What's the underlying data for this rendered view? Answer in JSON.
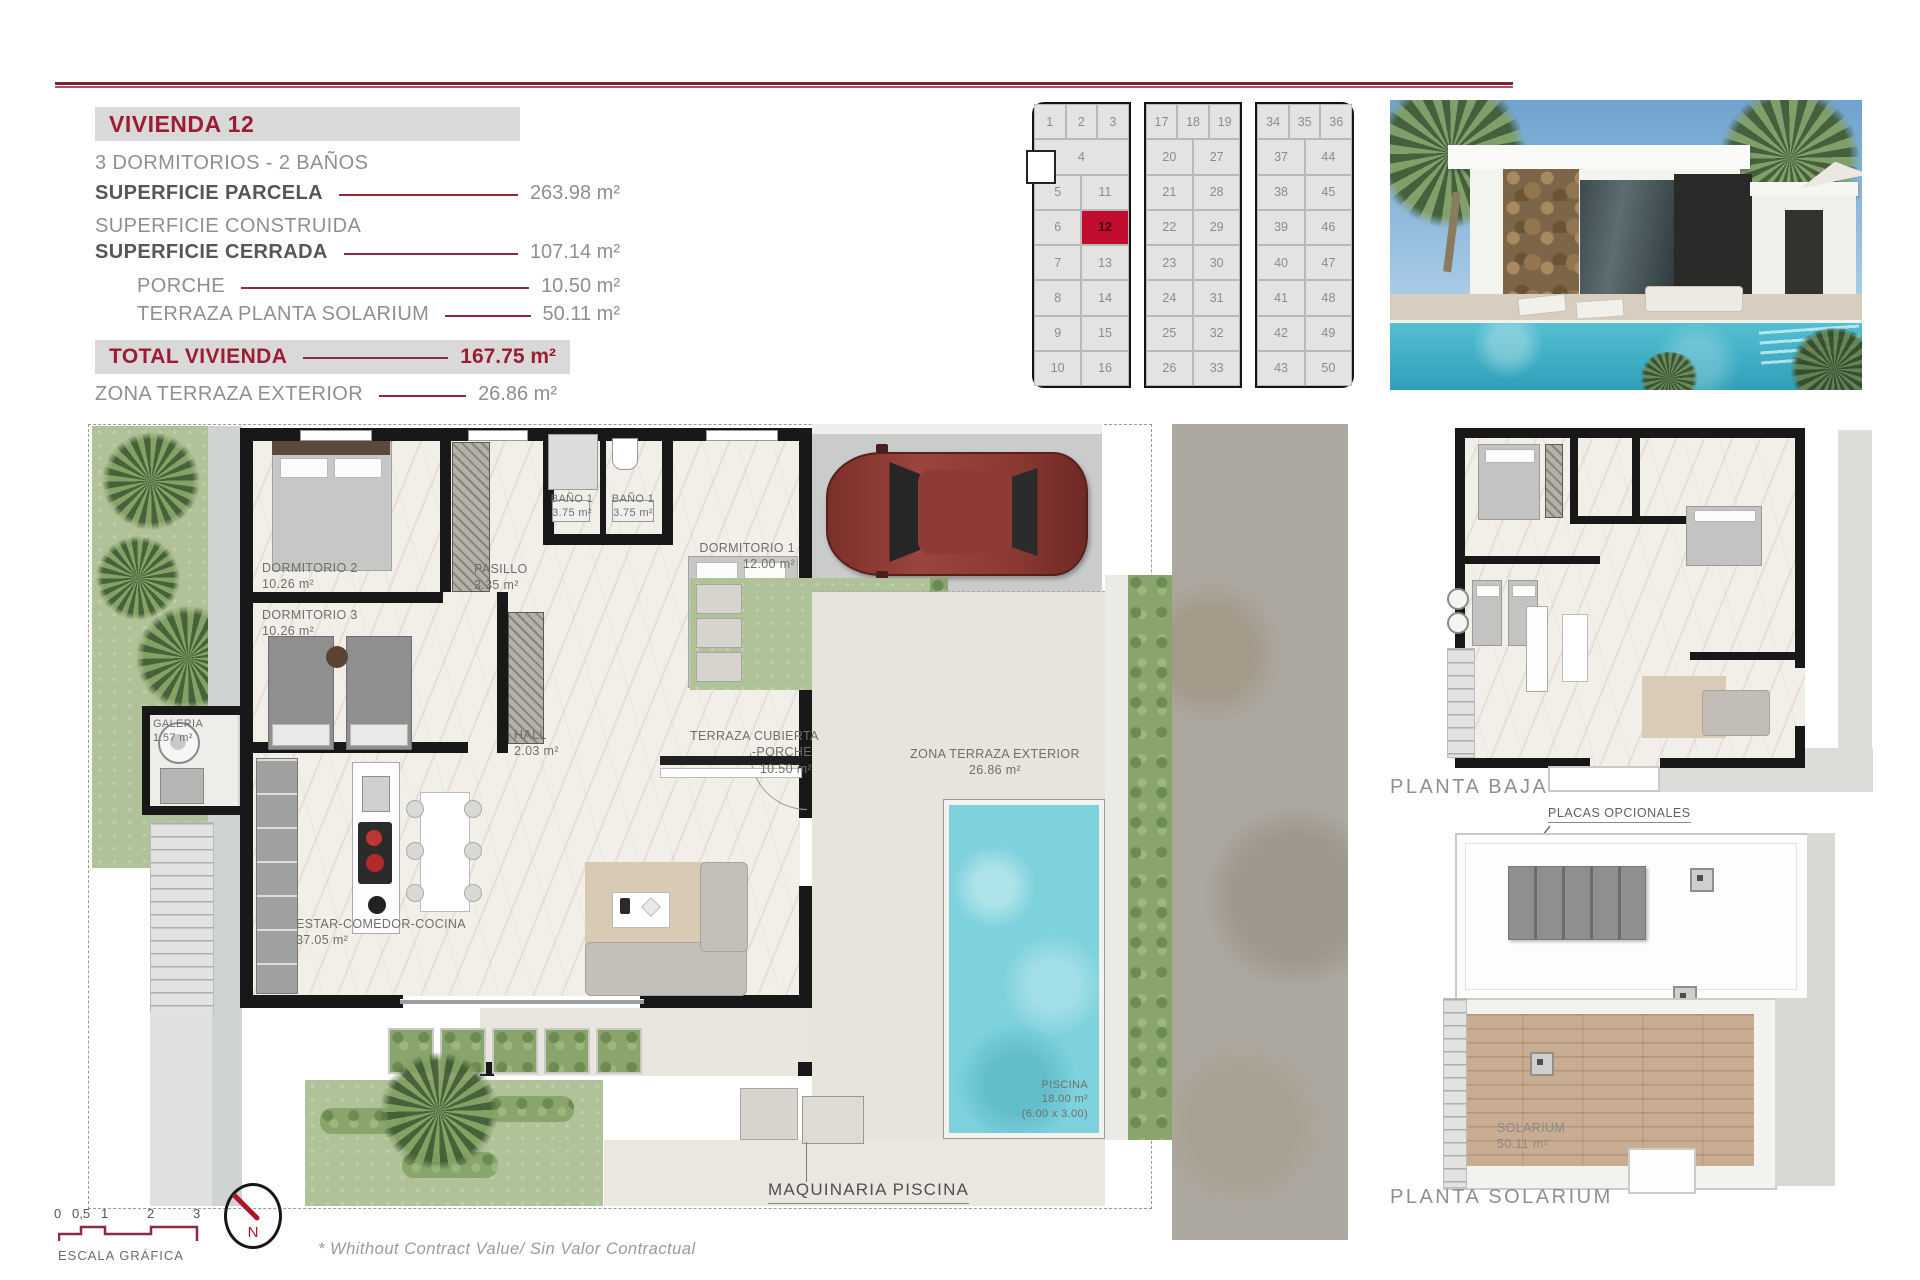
{
  "header": {
    "title": "VIVIENDA 12"
  },
  "specs": {
    "subtitle": "3 DORMITORIOS - 2 BAÑOS",
    "rows": [
      {
        "label": "SUPERFICIE PARCELA",
        "value": "263.98 m²"
      },
      {
        "label": "SUPERFICIE CONSTRUIDA",
        "value": ""
      },
      {
        "label": "SUPERFICIE CERRADA",
        "value": "107.14 m²"
      },
      {
        "label": "PORCHE",
        "value": "10.50 m²"
      },
      {
        "label": "TERRAZA PLANTA SOLARIUM",
        "value": "50.11 m²"
      }
    ],
    "total_label": "TOTAL VIVIENDA",
    "total_value": "167.75 m²",
    "extra_label": "ZONA TERRAZA EXTERIOR",
    "extra_value": "26.86 m²"
  },
  "site_grid": {
    "highlight": "12",
    "blocks": [
      {
        "top_row": [
          "1",
          "2",
          "3"
        ],
        "rows": [
          [
            "4"
          ],
          [
            "5",
            "11"
          ],
          [
            "6",
            "12"
          ],
          [
            "7",
            "13"
          ],
          [
            "8",
            "14"
          ],
          [
            "9",
            "15"
          ],
          [
            "10",
            "16"
          ]
        ]
      },
      {
        "top_row": [
          "17",
          "18",
          "19"
        ],
        "rows": [
          [
            "20",
            "27"
          ],
          [
            "21",
            "28"
          ],
          [
            "22",
            "29"
          ],
          [
            "23",
            "30"
          ],
          [
            "24",
            "31"
          ],
          [
            "25",
            "32"
          ],
          [
            "26",
            "33"
          ]
        ]
      },
      {
        "top_row": [
          "34",
          "35",
          "36"
        ],
        "rows": [
          [
            "37",
            "44"
          ],
          [
            "38",
            "45"
          ],
          [
            "39",
            "46"
          ],
          [
            "40",
            "47"
          ],
          [
            "41",
            "48"
          ],
          [
            "42",
            "49"
          ],
          [
            "43",
            "50"
          ]
        ]
      }
    ]
  },
  "floor_plan": {
    "rooms": [
      {
        "lines": [
          "DORMITORIO 2",
          "10.26 m²"
        ]
      },
      {
        "lines": [
          "DORMITORIO 3",
          "10.26 m²"
        ]
      },
      {
        "lines": [
          "BAÑO 1",
          "3.75 m²"
        ]
      },
      {
        "lines": [
          "BAÑO 1",
          "3.75 m²"
        ]
      },
      {
        "lines": [
          "PASILLO",
          "3.35 m²"
        ]
      },
      {
        "lines": [
          "DORMITORIO 1",
          "12.00 m²"
        ]
      },
      {
        "lines": [
          "HALL",
          "2.03 m²"
        ]
      },
      {
        "lines": [
          "GALERIA",
          "1.57 m²"
        ]
      },
      {
        "lines": [
          "ESTAR-COMEDOR-COCINA",
          "37.05 m²"
        ]
      },
      {
        "lines": [
          "TERRAZA CUBIERTA",
          "-PORCHE",
          "10.50 m²"
        ]
      },
      {
        "lines": [
          "ZONA TERRAZA EXTERIOR",
          "26.86 m²"
        ]
      },
      {
        "lines": [
          "PISCINA",
          "18.00 m²",
          "(6.00 x 3.00)"
        ]
      }
    ],
    "machine_label": "MAQUINARIA PISCINA"
  },
  "side_plans": {
    "planta_baja_label": "PLANTA BAJA",
    "placas_label": "PLACAS OPCIONALES",
    "solarium_lines": [
      "SOLARIUM",
      "50.11 m²"
    ],
    "planta_solarium_label": "PLANTA SOLARIUM"
  },
  "footer": {
    "scale_ticks": [
      "0",
      "0,5",
      "1",
      "2",
      "3"
    ],
    "scale_label": "ESCALA GRÁFICA",
    "north_label": "N",
    "note": "* Whithout Contract Value/ Sin Valor Contractual"
  },
  "colors": {
    "accent_red": "#9c1c33",
    "leader_red": "#8e2a3f",
    "plot_red": "#c20e2e",
    "band_gray": "#d9d9d9",
    "pool_blue": "#7ed2dd"
  }
}
